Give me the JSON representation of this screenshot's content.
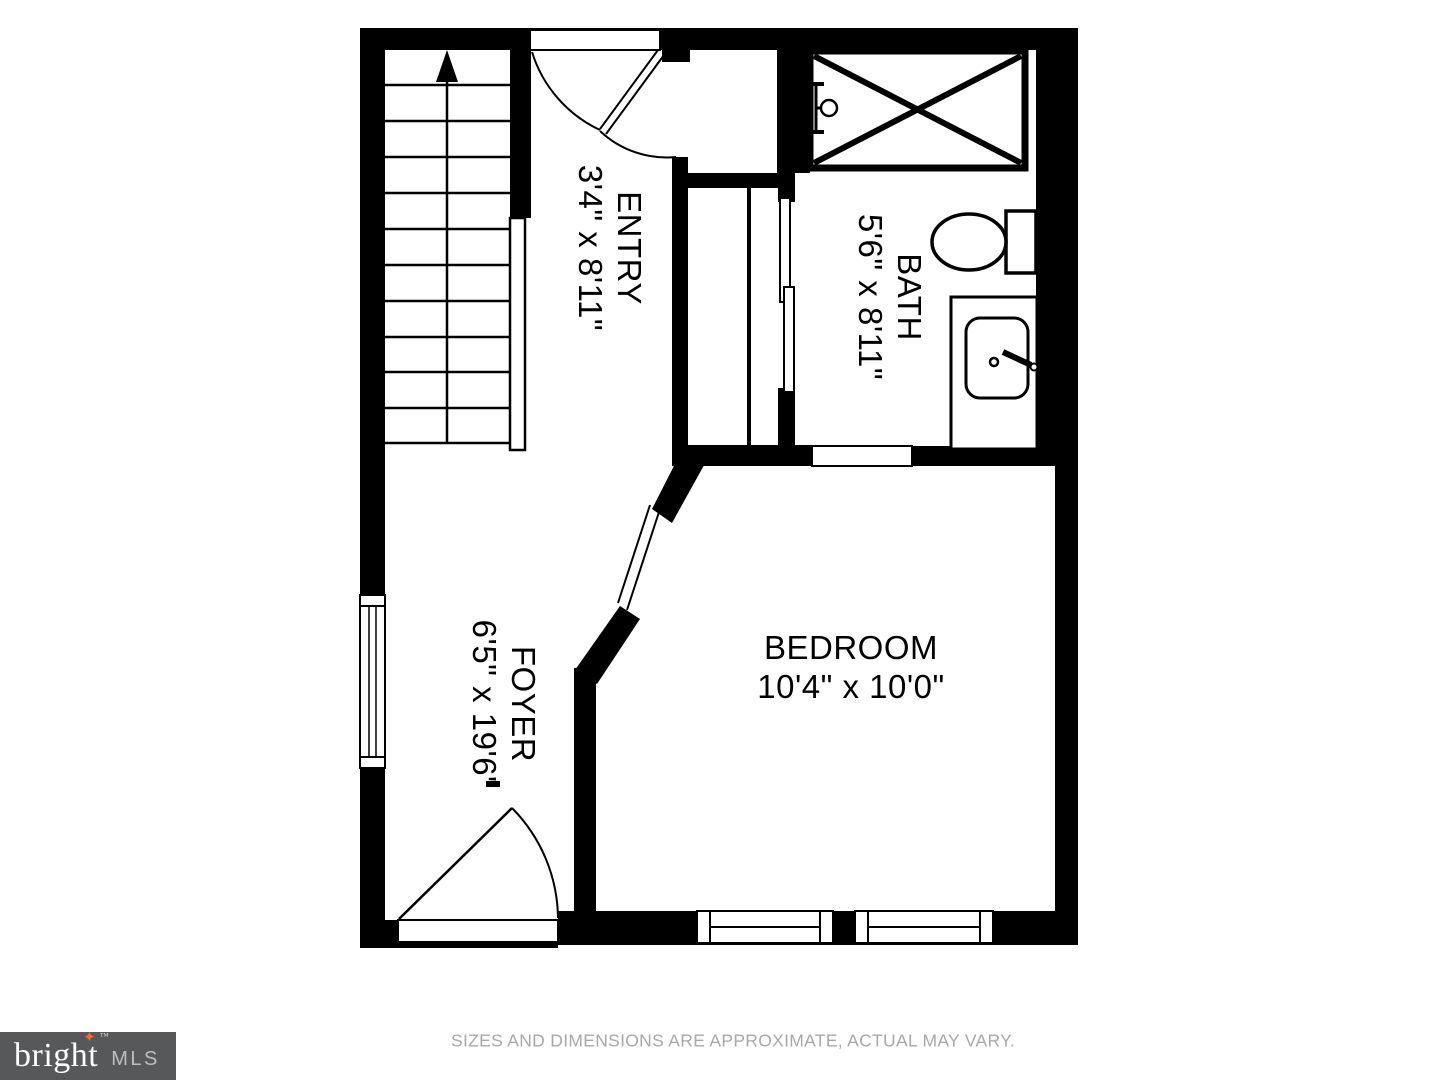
{
  "floor_plan": {
    "rooms": [
      {
        "name": "ENTRY",
        "dimensions": "3'4\" x 8'11\""
      },
      {
        "name": "BATH",
        "dimensions": "5'6\" x 8'11\""
      },
      {
        "name": "FOYER",
        "dimensions": "6'5\" x 19'6\""
      },
      {
        "name": "BEDROOM",
        "dimensions": "10'4\" x 10'0\""
      }
    ],
    "fixtures": [
      "staircase-up-arrow",
      "shower",
      "toilet",
      "sink-vanity",
      "sliding-closet-doors",
      "windows",
      "door-swings"
    ],
    "wall_color": "#000000",
    "floor_color": "#ffffff"
  },
  "branding": {
    "brand": "bright",
    "suffix": "MLS",
    "trademark": "™",
    "star_icon": "four-point-star",
    "colors": {
      "background": "#57585a",
      "brand_text": "#ffffff",
      "star": "#e8712f",
      "suffix_text": "#bdbec0"
    }
  },
  "footer": {
    "disclaimer": "SIZES AND DIMENSIONS ARE APPROXIMATE, ACTUAL MAY VARY."
  }
}
